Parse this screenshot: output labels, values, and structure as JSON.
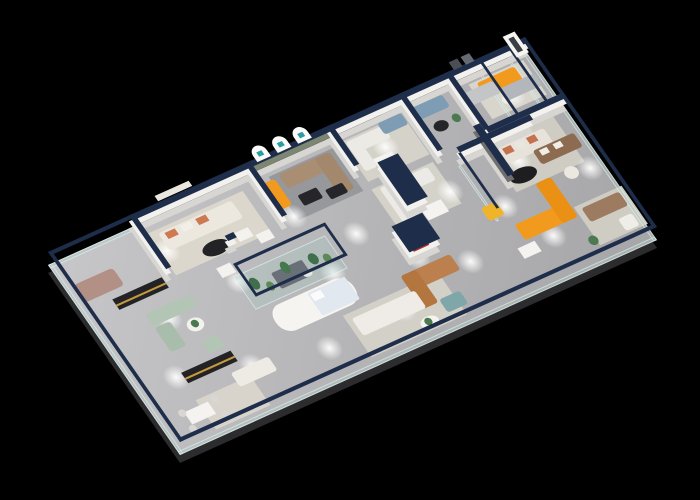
{
  "scene": {
    "width": 700,
    "height": 500,
    "background": "#000000"
  },
  "projection": {
    "a": 0.8518,
    "b": -0.3839,
    "c": 0.6,
    "d": 0.8636,
    "e": 48,
    "f": 265,
    "cap_rise": 13,
    "mid_rise": 7,
    "slab_drop": 8
  },
  "floor": {
    "w": 560,
    "h": 220,
    "slab_color": "#2c2c2e"
  },
  "palette": {
    "wall_face": "#f3f1ed",
    "wall_shadow": "#d8d6d2",
    "wall_cap": "#1e2d49",
    "glass_fill": "rgba(165,205,195,0.28)",
    "glass_edge": "rgba(235,250,250,0.55)",
    "accent_orange": "#f29a1e",
    "accent_red": "#a93527",
    "sage_wall": "#7c8672"
  },
  "rugs": [
    {
      "name": "rug-lounge-1",
      "x": 108,
      "y": 12,
      "w": 112,
      "h": 48,
      "color": "#dcd7cc"
    },
    {
      "name": "rug-arch-room",
      "x": 252,
      "y": 10,
      "w": 76,
      "h": 50,
      "color": "#96989c"
    },
    {
      "name": "rug-bay-3",
      "x": 338,
      "y": 8,
      "w": 72,
      "h": 46,
      "color": "#d5d2c9"
    },
    {
      "name": "rug-mid-left",
      "x": 336,
      "y": 62,
      "w": 72,
      "h": 48,
      "color": "#d5d2ca"
    },
    {
      "name": "rug-feature-room",
      "x": 464,
      "y": 70,
      "w": 80,
      "h": 52,
      "color": "#cfccc3"
    },
    {
      "name": "rug-suite",
      "x": 488,
      "y": 8,
      "w": 64,
      "h": 40,
      "color": "#d8d5cd"
    },
    {
      "name": "rug-front-left",
      "x": 48,
      "y": 178,
      "w": 64,
      "h": 34,
      "color": "#d8d4cb"
    },
    {
      "name": "rug-front-mid",
      "x": 232,
      "y": 162,
      "w": 112,
      "h": 48,
      "color": "#d3d0c8"
    },
    {
      "name": "rug-corner",
      "x": 506,
      "y": 158,
      "w": 56,
      "h": 44,
      "color": "#cfccc4"
    }
  ],
  "walls": [
    {
      "name": "back-wall-1",
      "x": 95,
      "y": 0,
      "w": 140,
      "h": 6
    },
    {
      "name": "arch-wall",
      "x": 235,
      "y": 0,
      "w": 95,
      "h": 6,
      "face": "#7c8672"
    },
    {
      "name": "back-wall-2",
      "x": 330,
      "y": 0,
      "w": 230,
      "h": 6
    },
    {
      "name": "wall-bay1-left",
      "x": 95,
      "y": 0,
      "w": 6,
      "h": 62
    },
    {
      "name": "wall-bay1-right",
      "x": 231,
      "y": 0,
      "w": 6,
      "h": 62
    },
    {
      "name": "wall-arch-right",
      "x": 327,
      "y": 0,
      "w": 6,
      "h": 46
    },
    {
      "name": "wall-bay3",
      "x": 411,
      "y": 0,
      "w": 6,
      "h": 66
    },
    {
      "name": "wall-bay4",
      "x": 466,
      "y": 0,
      "w": 6,
      "h": 66
    },
    {
      "name": "wall-suite-front",
      "x": 468,
      "y": 64,
      "w": 92,
      "h": 6
    },
    {
      "name": "wall-mid-right",
      "x": 430,
      "y": 70,
      "w": 86,
      "h": 6
    },
    {
      "name": "wall-feature",
      "x": 458,
      "y": 58,
      "w": 8,
      "h": 58,
      "face": "#6f6f71"
    },
    {
      "name": "wall-red-niche",
      "x": 350,
      "y": 52,
      "w": 24,
      "h": 50
    },
    {
      "name": "wall-brand-logo",
      "x": 323,
      "y": 114,
      "w": 36,
      "h": 30
    },
    {
      "name": "wall-stub",
      "x": 168,
      "y": 56,
      "w": 10,
      "h": 6
    }
  ],
  "glass": [
    {
      "name": "glass-left",
      "x": 0,
      "y": 0,
      "w": 4,
      "h": 220
    },
    {
      "name": "glass-front",
      "x": 0,
      "y": 216,
      "w": 560,
      "h": 4
    },
    {
      "name": "glass-right",
      "x": 556,
      "y": 0,
      "w": 4,
      "h": 220
    },
    {
      "name": "glass-back-left",
      "x": 0,
      "y": 0,
      "w": 95,
      "h": 4
    },
    {
      "name": "glass-bay-partition-1",
      "x": 504,
      "y": 4,
      "w": 3,
      "h": 62
    },
    {
      "name": "glass-bay-partition-2",
      "x": 538,
      "y": 4,
      "w": 3,
      "h": 62
    },
    {
      "name": "glass-rail-mid",
      "x": 428,
      "y": 76,
      "w": 3,
      "h": 64
    }
  ],
  "terrarium": {
    "name": "glass-terrarium",
    "x": 158,
    "y": 84,
    "w": 108,
    "h": 38
  },
  "decor": [
    {
      "name": "arch-niche",
      "layer": "cap",
      "x": 243,
      "y": -11,
      "w": 16,
      "h": 15,
      "color": "#fbfbfa",
      "radius": "8px 8px 0 0"
    },
    {
      "name": "arch-niche",
      "layer": "cap",
      "x": 267,
      "y": -11,
      "w": 16,
      "h": 15,
      "color": "#fbfbfa",
      "radius": "8px 8px 0 0"
    },
    {
      "name": "arch-niche",
      "layer": "cap",
      "x": 291,
      "y": -11,
      "w": 16,
      "h": 15,
      "color": "#fbfbfa",
      "radius": "8px 8px 0 0"
    },
    {
      "name": "arch-logo-mark",
      "layer": "cap",
      "x": 248,
      "y": -5,
      "w": 6,
      "h": 5,
      "color": "#2a9d9f"
    },
    {
      "name": "arch-logo-mark",
      "layer": "cap",
      "x": 272,
      "y": -5,
      "w": 6,
      "h": 5,
      "color": "#2a9d9f"
    },
    {
      "name": "arch-logo-mark",
      "layer": "cap",
      "x": 296,
      "y": -5,
      "w": 6,
      "h": 5,
      "color": "#2a9d9f"
    },
    {
      "name": "red-arch-niche",
      "layer": "mid",
      "x": 355,
      "y": 58,
      "w": 13,
      "h": 28,
      "color": "#a93527",
      "radius": "7px 7px 0 0"
    },
    {
      "name": "brand-logo-red",
      "layer": "mid",
      "x": 334,
      "y": 122,
      "w": 12,
      "h": 12,
      "color": "#a93527"
    },
    {
      "name": "brand-logo-text-line",
      "layer": "mid",
      "x": 331,
      "y": 137,
      "w": 18,
      "h": 3,
      "color": "#a93527"
    },
    {
      "name": "poster-person-board",
      "layer": "cap",
      "x": 540,
      "y": -9,
      "w": 14,
      "h": 24,
      "color": "#f6f5f2"
    },
    {
      "name": "poster-person-figure",
      "layer": "cap",
      "x": 544,
      "y": -5,
      "w": 6,
      "h": 16,
      "color": "#3a3f46"
    },
    {
      "name": "wall-sign-board",
      "layer": "cap",
      "x": 130,
      "y": -7,
      "w": 40,
      "h": 6,
      "color": "#eae7e1"
    },
    {
      "name": "wall-frame",
      "layer": "cap",
      "x": 476,
      "y": -8,
      "w": 10,
      "h": 9,
      "color": "#4a4f57"
    },
    {
      "name": "wall-frame",
      "layer": "cap",
      "x": 490,
      "y": -8,
      "w": 10,
      "h": 9,
      "color": "#666b73"
    }
  ],
  "furniture": [
    {
      "name": "mauve-sofa",
      "x": 10,
      "y": 28,
      "w": 46,
      "h": 20,
      "color": "#b29086",
      "r": 4
    },
    {
      "name": "media-console",
      "x": 36,
      "y": 56,
      "w": 58,
      "h": 12,
      "color": "#232326"
    },
    {
      "name": "console-brass-stripe",
      "x": 36,
      "y": 62,
      "w": 58,
      "h": 2,
      "color": "#c59a3f"
    },
    {
      "name": "sage-sofa",
      "x": 56,
      "y": 82,
      "w": 52,
      "h": 14,
      "color": "#b3c6b6",
      "r": 3
    },
    {
      "name": "sage-chaise",
      "x": 56,
      "y": 98,
      "w": 18,
      "h": 28,
      "color": "#a9bdad",
      "r": 3
    },
    {
      "name": "sage-armchair",
      "x": 90,
      "y": 128,
      "w": 18,
      "h": 14,
      "color": "#b3c6b6",
      "r": 3
    },
    {
      "name": "round-table",
      "shape": "ellipse",
      "x": 86,
      "y": 104,
      "w": 18,
      "h": 14,
      "color": "#f4f2ee"
    },
    {
      "name": "table-plant",
      "shape": "ellipse",
      "x": 91,
      "y": 106,
      "w": 8,
      "h": 8,
      "color": "#4c7a50"
    },
    {
      "name": "media-console",
      "x": 52,
      "y": 148,
      "w": 58,
      "h": 12,
      "color": "#232326"
    },
    {
      "name": "console-brass-stripe",
      "x": 52,
      "y": 154,
      "w": 58,
      "h": 2,
      "color": "#c59a3f"
    },
    {
      "name": "white-sofa",
      "x": 96,
      "y": 168,
      "w": 44,
      "h": 16,
      "color": "#eeebe5",
      "r": 3
    },
    {
      "name": "dining-table",
      "x": 30,
      "y": 184,
      "w": 28,
      "h": 14,
      "color": "#f5f3ef"
    },
    {
      "name": "dining-chair",
      "shape": "ellipse",
      "x": 24,
      "y": 180,
      "w": 8,
      "h": 8,
      "color": "#d8d7d3"
    },
    {
      "name": "dining-chair",
      "shape": "ellipse",
      "x": 24,
      "y": 198,
      "w": 8,
      "h": 8,
      "color": "#d8d7d3"
    },
    {
      "name": "dining-chair",
      "shape": "ellipse",
      "x": 62,
      "y": 180,
      "w": 8,
      "h": 8,
      "color": "#d8d7d3"
    },
    {
      "name": "dining-chair",
      "shape": "ellipse",
      "x": 62,
      "y": 198,
      "w": 8,
      "h": 8,
      "color": "#d8d7d3"
    },
    {
      "name": "display-pedestal",
      "x": 148,
      "y": 70,
      "w": 16,
      "h": 11,
      "color": "#f4f2ee"
    },
    {
      "name": "display-pedestal",
      "x": 186,
      "y": 46,
      "w": 16,
      "h": 10,
      "color": "#f4f2ee"
    },
    {
      "name": "terracotta-trim-sofa",
      "x": 118,
      "y": 16,
      "w": 86,
      "h": 20,
      "color": "#ece7df",
      "r": 3
    },
    {
      "name": "sofa-pillow",
      "x": 124,
      "y": 18,
      "w": 12,
      "h": 7,
      "color": "#cd7a52"
    },
    {
      "name": "sofa-pillow",
      "x": 142,
      "y": 18,
      "w": 12,
      "h": 7,
      "color": "#f2efe9"
    },
    {
      "name": "sofa-pillow",
      "x": 160,
      "y": 18,
      "w": 12,
      "h": 7,
      "color": "#cd7a52"
    },
    {
      "name": "black-oval-table",
      "shape": "ellipse",
      "x": 146,
      "y": 44,
      "w": 30,
      "h": 15,
      "color": "#232325"
    },
    {
      "name": "orange-bench",
      "x": 240,
      "y": 14,
      "w": 16,
      "h": 30,
      "color": "#f29a1e",
      "r": 3
    },
    {
      "name": "taupe-sofa",
      "x": 262,
      "y": 12,
      "w": 58,
      "h": 16,
      "color": "#a98e74",
      "r": 3
    },
    {
      "name": "taupe-chaise",
      "x": 304,
      "y": 12,
      "w": 18,
      "h": 42,
      "color": "#a3886e",
      "r": 3
    },
    {
      "name": "black-coffee-table",
      "x": 266,
      "y": 38,
      "w": 22,
      "h": 12,
      "color": "#26262a",
      "r": 2
    },
    {
      "name": "black-coffee-table",
      "x": 294,
      "y": 44,
      "w": 20,
      "h": 11,
      "color": "#26262a",
      "r": 2
    },
    {
      "name": "white-sofa",
      "x": 342,
      "y": 10,
      "w": 44,
      "h": 14,
      "color": "#eceae4",
      "r": 3
    },
    {
      "name": "white-chaise",
      "x": 342,
      "y": 10,
      "w": 14,
      "h": 34,
      "color": "#eceae4",
      "r": 3
    },
    {
      "name": "blue-sofa",
      "x": 382,
      "y": 6,
      "w": 28,
      "h": 13,
      "color": "#7e9db5",
      "r": 3
    },
    {
      "name": "dining-table",
      "x": 356,
      "y": 36,
      "w": 22,
      "h": 13,
      "color": "#f5f3ef"
    },
    {
      "name": "blue-sofa",
      "x": 422,
      "y": 6,
      "w": 36,
      "h": 14,
      "color": "#7e9db5",
      "r": 3
    },
    {
      "name": "black-round-table",
      "shape": "ellipse",
      "x": 430,
      "y": 28,
      "w": 16,
      "h": 11,
      "color": "#26262a"
    },
    {
      "name": "floor-plant",
      "shape": "ellipse",
      "x": 452,
      "y": 28,
      "w": 9,
      "h": 9,
      "color": "#4c7a50"
    },
    {
      "name": "orange-sofa",
      "x": 496,
      "y": 10,
      "w": 44,
      "h": 16,
      "color": "#f29a1e",
      "r": 3
    },
    {
      "name": "side-table",
      "shape": "ellipse",
      "x": 508,
      "y": 32,
      "w": 12,
      "h": 9,
      "color": "#f0eee9"
    },
    {
      "name": "white-l-sofa",
      "x": 344,
      "y": 64,
      "w": 56,
      "h": 15,
      "color": "#eceae6",
      "r": 3
    },
    {
      "name": "white-l-chaise",
      "x": 344,
      "y": 64,
      "w": 15,
      "h": 42,
      "color": "#eceae6",
      "r": 3
    },
    {
      "name": "sofa-pillow",
      "x": 352,
      "y": 66,
      "w": 9,
      "h": 6,
      "color": "#8fb0c8"
    },
    {
      "name": "dining-table",
      "x": 368,
      "y": 98,
      "w": 24,
      "h": 14,
      "color": "#f5f3ef"
    },
    {
      "name": "striped-sofa",
      "x": 474,
      "y": 76,
      "w": 54,
      "h": 18,
      "color": "#e7e2da",
      "r": 3
    },
    {
      "name": "sofa-pillow",
      "x": 478,
      "y": 78,
      "w": 10,
      "h": 7,
      "color": "#c4714f"
    },
    {
      "name": "sofa-pillow",
      "x": 492,
      "y": 78,
      "w": 10,
      "h": 7,
      "color": "#e9e6df"
    },
    {
      "name": "sofa-pillow",
      "x": 506,
      "y": 78,
      "w": 10,
      "h": 7,
      "color": "#c4714f"
    },
    {
      "name": "black-oval-table",
      "shape": "ellipse",
      "x": 466,
      "y": 102,
      "w": 30,
      "h": 15,
      "color": "#1e1e21"
    },
    {
      "name": "gray-sofa",
      "x": 470,
      "y": 14,
      "w": 42,
      "h": 14,
      "color": "#c3c5c7",
      "r": 3
    },
    {
      "name": "gray-sofa",
      "x": 512,
      "y": 24,
      "w": 42,
      "h": 14,
      "color": "#b3b7bb",
      "r": 3
    },
    {
      "name": "brown-sofa",
      "x": 504,
      "y": 92,
      "w": 48,
      "h": 16,
      "color": "#8d6b51",
      "r": 3
    },
    {
      "name": "sofa-pillow",
      "x": 510,
      "y": 94,
      "w": 9,
      "h": 6,
      "color": "#f1eee8"
    },
    {
      "name": "sofa-pillow",
      "x": 526,
      "y": 94,
      "w": 9,
      "h": 6,
      "color": "#f1eee8"
    },
    {
      "name": "wicker-armchair",
      "shape": "ellipse",
      "x": 518,
      "y": 120,
      "w": 15,
      "h": 13,
      "color": "#ebe8e1"
    },
    {
      "name": "terrarium-bed",
      "x": 194,
      "y": 96,
      "w": 36,
      "h": 18,
      "color": "#697077",
      "r": 2
    },
    {
      "name": "terrarium-plant",
      "shape": "ellipse",
      "x": 168,
      "y": 92,
      "w": 10,
      "h": 13,
      "color": "#3f6f4b"
    },
    {
      "name": "terrarium-plant",
      "shape": "ellipse",
      "x": 182,
      "y": 102,
      "w": 8,
      "h": 10,
      "color": "#5c8a57"
    },
    {
      "name": "terrarium-plant",
      "shape": "ellipse",
      "x": 206,
      "y": 90,
      "w": 9,
      "h": 13,
      "color": "#46784e"
    },
    {
      "name": "terrarium-plant",
      "shape": "ellipse",
      "x": 236,
      "y": 94,
      "w": 10,
      "h": 12,
      "color": "#3f6f4b"
    },
    {
      "name": "terrarium-plant",
      "shape": "ellipse",
      "x": 250,
      "y": 100,
      "w": 8,
      "h": 10,
      "color": "#5c8a57"
    },
    {
      "name": "terrarium-pebbles",
      "shape": "ellipse",
      "x": 222,
      "y": 108,
      "w": 10,
      "h": 6,
      "color": "#e8e6e0"
    },
    {
      "name": "curved-counter",
      "x": 168,
      "y": 126,
      "w": 92,
      "h": 30,
      "color": "#f6f4f0",
      "r": 14
    },
    {
      "name": "display-bed",
      "x": 214,
      "y": 128,
      "w": 44,
      "h": 26,
      "color": "#e2e8ef",
      "r": 2
    },
    {
      "name": "bed-pillow",
      "x": 216,
      "y": 130,
      "w": 12,
      "h": 8,
      "color": "#fbfbfb"
    },
    {
      "name": "caramel-sofa",
      "x": 308,
      "y": 150,
      "w": 58,
      "h": 18,
      "color": "#bc7f4e",
      "r": 3
    },
    {
      "name": "caramel-chaise",
      "x": 308,
      "y": 150,
      "w": 18,
      "h": 38,
      "color": "#b3763f",
      "r": 3
    },
    {
      "name": "white-front-sofa",
      "x": 238,
      "y": 168,
      "w": 74,
      "h": 20,
      "color": "#efece7",
      "r": 3
    },
    {
      "name": "teal-ottoman",
      "x": 328,
      "y": 186,
      "w": 24,
      "h": 15,
      "color": "#7fa6a8",
      "r": 3
    },
    {
      "name": "round-table",
      "shape": "ellipse",
      "x": 296,
      "y": 196,
      "w": 20,
      "h": 12,
      "color": "#f5f3ef"
    },
    {
      "name": "table-plant",
      "shape": "ellipse",
      "x": 301,
      "y": 197,
      "w": 8,
      "h": 8,
      "color": "#4c7a50"
    },
    {
      "name": "orange-l-sofa",
      "x": 442,
      "y": 150,
      "w": 62,
      "h": 18,
      "color": "#f29a1e",
      "r": 3
    },
    {
      "name": "orange-l-chaise",
      "x": 486,
      "y": 122,
      "w": 18,
      "h": 46,
      "color": "#ea9015",
      "r": 3
    },
    {
      "name": "yellow-armchair",
      "x": 422,
      "y": 122,
      "w": 18,
      "h": 15,
      "color": "#f0b42a",
      "r": 3
    },
    {
      "name": "writing-desk",
      "x": 430,
      "y": 172,
      "w": 20,
      "h": 12,
      "color": "#f5f3ef"
    },
    {
      "name": "corner-brown-sofa",
      "x": 512,
      "y": 162,
      "w": 44,
      "h": 16,
      "color": "#9c7b60",
      "r": 3
    },
    {
      "name": "white-armchair",
      "x": 538,
      "y": 186,
      "w": 16,
      "h": 14,
      "color": "#efede7",
      "r": 3
    },
    {
      "name": "floor-plant",
      "shape": "ellipse",
      "x": 498,
      "y": 190,
      "w": 10,
      "h": 10,
      "color": "#4c7a50"
    },
    {
      "name": "display-pedestal",
      "x": 204,
      "y": 56,
      "w": 16,
      "h": 10,
      "color": "#f4f2ee"
    }
  ],
  "lights": [
    {
      "x": 115,
      "y": 35
    },
    {
      "x": 160,
      "y": 90
    },
    {
      "x": 205,
      "y": 140
    },
    {
      "x": 250,
      "y": 55
    },
    {
      "x": 295,
      "y": 95
    },
    {
      "x": 335,
      "y": 140
    },
    {
      "x": 375,
      "y": 30
    },
    {
      "x": 405,
      "y": 95
    },
    {
      "x": 445,
      "y": 130
    },
    {
      "x": 485,
      "y": 95
    },
    {
      "x": 520,
      "y": 35
    },
    {
      "x": 545,
      "y": 130
    },
    {
      "x": 75,
      "y": 95
    },
    {
      "x": 45,
      "y": 150
    },
    {
      "x": 120,
      "y": 170
    },
    {
      "x": 200,
      "y": 185
    },
    {
      "x": 290,
      "y": 180
    },
    {
      "x": 380,
      "y": 165
    },
    {
      "x": 470,
      "y": 175
    },
    {
      "x": 250,
      "y": 120
    }
  ]
}
